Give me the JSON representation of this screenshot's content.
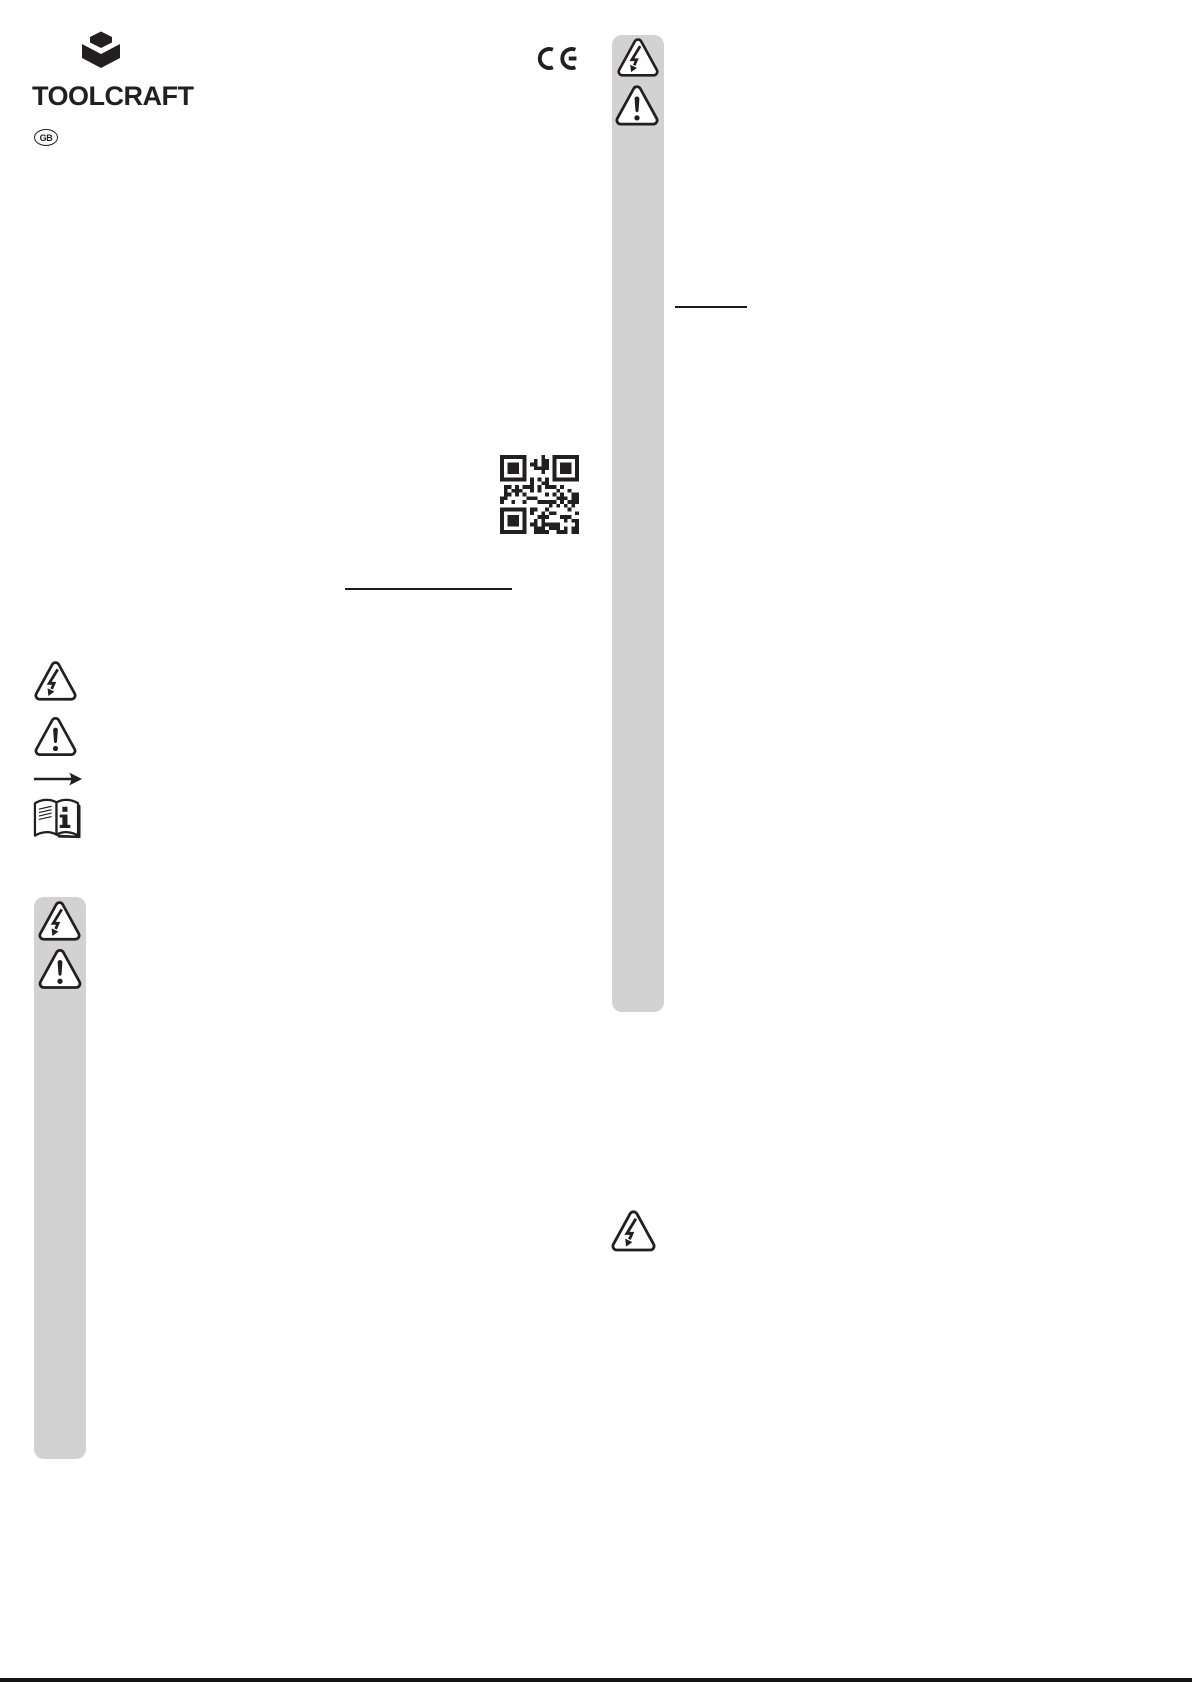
{
  "page": {
    "background": "#ffffff",
    "ink_color": "#231f20",
    "panel_color": "#d2d2d2"
  },
  "header": {
    "brand": "TOOLCRAFT",
    "language_badge": "GB"
  },
  "marks": {
    "ce": "CE"
  },
  "icons": {
    "logo": "toolcraft-cube-logo",
    "ce": "ce-conformity-mark",
    "qr": "qr-code",
    "high_voltage": "high-voltage-warning-triangle",
    "general_warning": "exclamation-warning-triangle",
    "arrow": "arrow-right",
    "manual": "read-manual-booklet"
  }
}
